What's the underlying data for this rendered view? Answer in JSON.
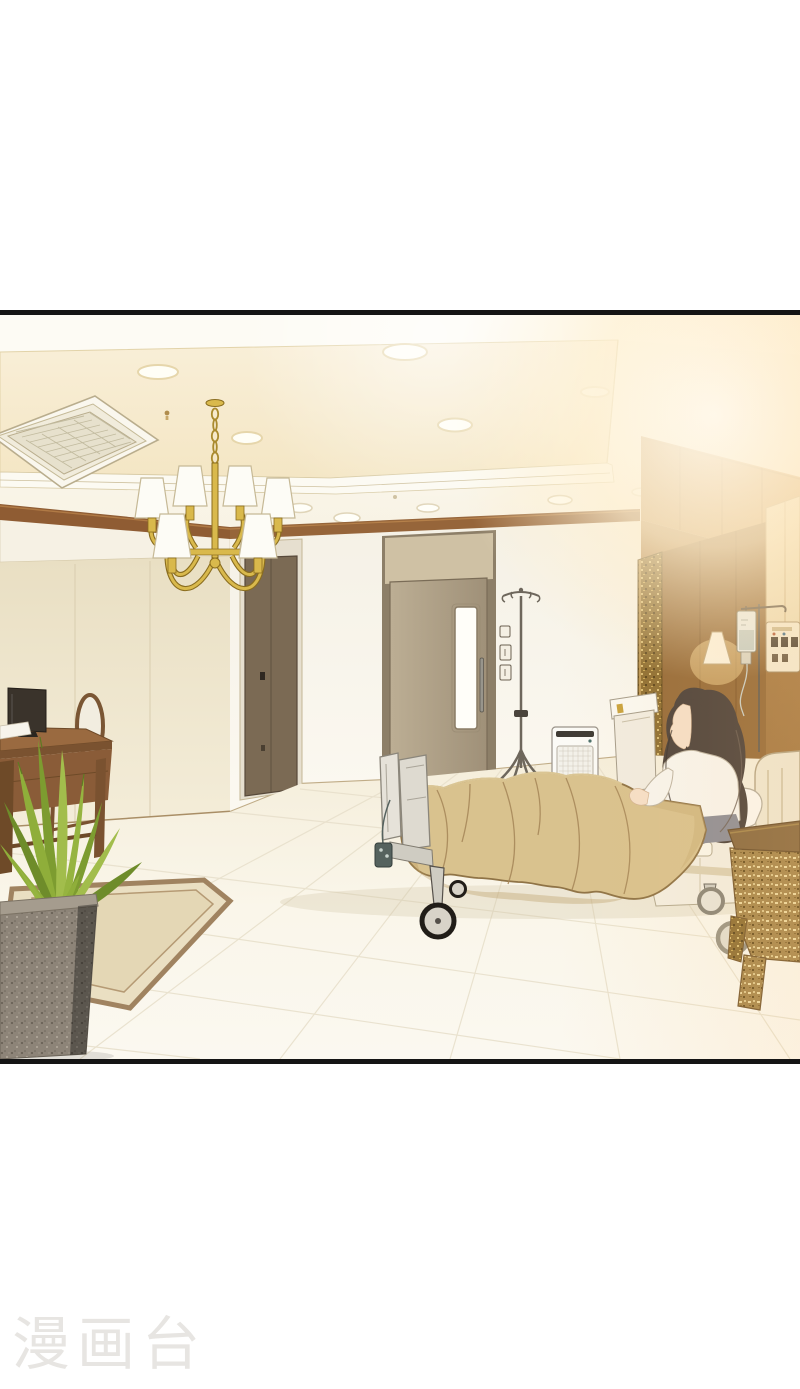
{
  "page": {
    "width": 800,
    "height": 1389,
    "background_color": "#ffffff",
    "watermark": {
      "text": "漫画台",
      "color": "#e7e5e2"
    }
  },
  "panel": {
    "type": "borderless-wide-comic-panel",
    "border_color": "#151515",
    "scene_description": "VIP hospital ward interior, warm sunlight glow from the upper right",
    "objects": [
      "recessed tray ceiling with downlights",
      "ceiling air-conditioning vent",
      "gold chandelier with white shades",
      "brown crown molding",
      "dark interior door",
      "entrance door with vertical window",
      "light switches",
      "IV drip stand",
      "air purifier",
      "wall lamp",
      "hanging IV bag",
      "bed head unit panel",
      "gilded carved pillar",
      "cream side cabinet",
      "hospital bed with tan blanket",
      "patient with long wavy dark hair",
      "white pillow",
      "bed headboard",
      "footboard rails and control pendant",
      "caster wheels",
      "bedside locker",
      "gilded overbed table",
      "vanity desk with oval-back chair",
      "dark photo frame on desk",
      "white papers on desk",
      "potted plant in stone planter",
      "inset bordered carpet",
      "white tiled floor"
    ],
    "palette": {
      "border-color": "#151515",
      "page-bg": "#ffffff",
      "watermark-color": "#e7e5e2",
      "ceiling-white": "#fbf6ea",
      "ceiling-cream": "#f8edd3",
      "molding-brown": "#8f5c33",
      "wall-beige": "#ece2c8",
      "wall-white": "#f8f4eb",
      "right-wall-warm": "#c0955f",
      "glow-warm": "#ffeecb",
      "door-dark": "#7b6a54",
      "door-tan": "#b2a489",
      "blanket-tan": "#d9c28e",
      "blanket-line": "#a8895b",
      "gold": "#d9b94c",
      "gold-dark": "#8a6d1f",
      "hair-brown": "#4e433c",
      "skin": "#f5dfc8",
      "plant-green": "#8fae3a",
      "planter-gray": "#8d8478",
      "wood-brown": "#8a5c38",
      "floor-cream": "#f8f2e2"
    }
  }
}
